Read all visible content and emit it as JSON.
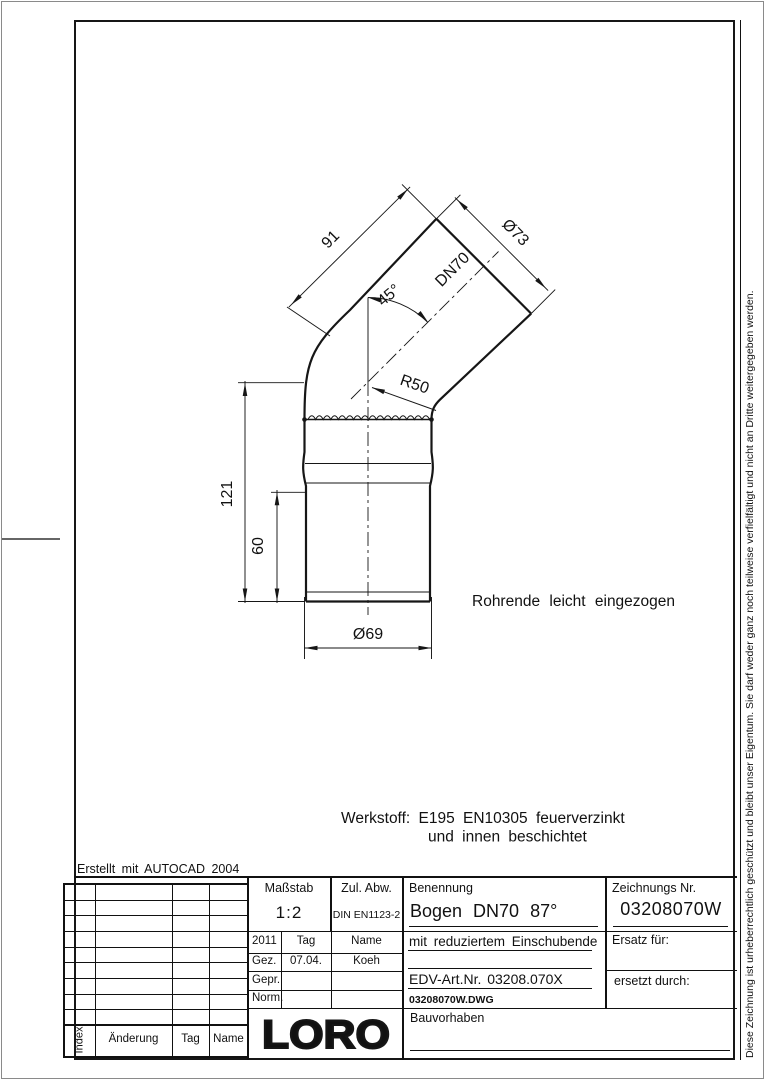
{
  "drawing": {
    "dim_length_diagonal": "91",
    "dim_dia_spigot": "Ø73",
    "dim_dn": "DN70",
    "dim_angle": "45°",
    "dim_radius": "R50",
    "dim_height_total": "121",
    "dim_height_insert": "60",
    "dim_dia_socket": "Ø69",
    "note_pipe_end": "Rohrende leicht eingezogen",
    "note_material_1": "Werkstoff: E195 EN10305 feuerverzinkt",
    "note_material_2": "und innen beschichtet",
    "created_with": "Erstellt mit AUTOCAD 2004"
  },
  "title_block": {
    "massstab_label": "Maßstab",
    "massstab_value": "1:2",
    "zul_abw_label": "Zul. Abw.",
    "zul_abw_value": "DIN EN1123-2",
    "benennung_label": "Benennung",
    "benennung_value": "Bogen DN70 87°",
    "zeichnungs_nr_label": "Zeichnungs Nr.",
    "zeichnungs_nr_value": "03208070W",
    "year": "2011",
    "col_tag": "Tag",
    "col_name": "Name",
    "row_gez": "Gez.",
    "gez_tag": "07.04.",
    "gez_name": "Koeh",
    "row_gepr": "Gepr.",
    "row_norm": "Norm.",
    "subtitle": "mit reduziertem Einschubende",
    "edv_art_nr": "EDV-Art.Nr.  03208.070X",
    "dwg_file": "03208070W.DWG",
    "ersatz_fuer_label": "Ersatz für:",
    "ersetzt_durch_label": "ersetzt durch:",
    "bauvorhaben_label": "Bauvorhaben",
    "logo_text": "LORO"
  },
  "revision_table": {
    "index_label": "Index",
    "aenderung_label": "Änderung",
    "tag_label": "Tag",
    "name_label": "Name"
  },
  "margin": {
    "copyright_vertical": "Diese Zeichnung ist urheberrechtlich geschützt und bleibt unser Eigentum. Sie darf weder ganz noch teilweise verfielfältigt und nicht an Dritte weitergegeben werden."
  }
}
